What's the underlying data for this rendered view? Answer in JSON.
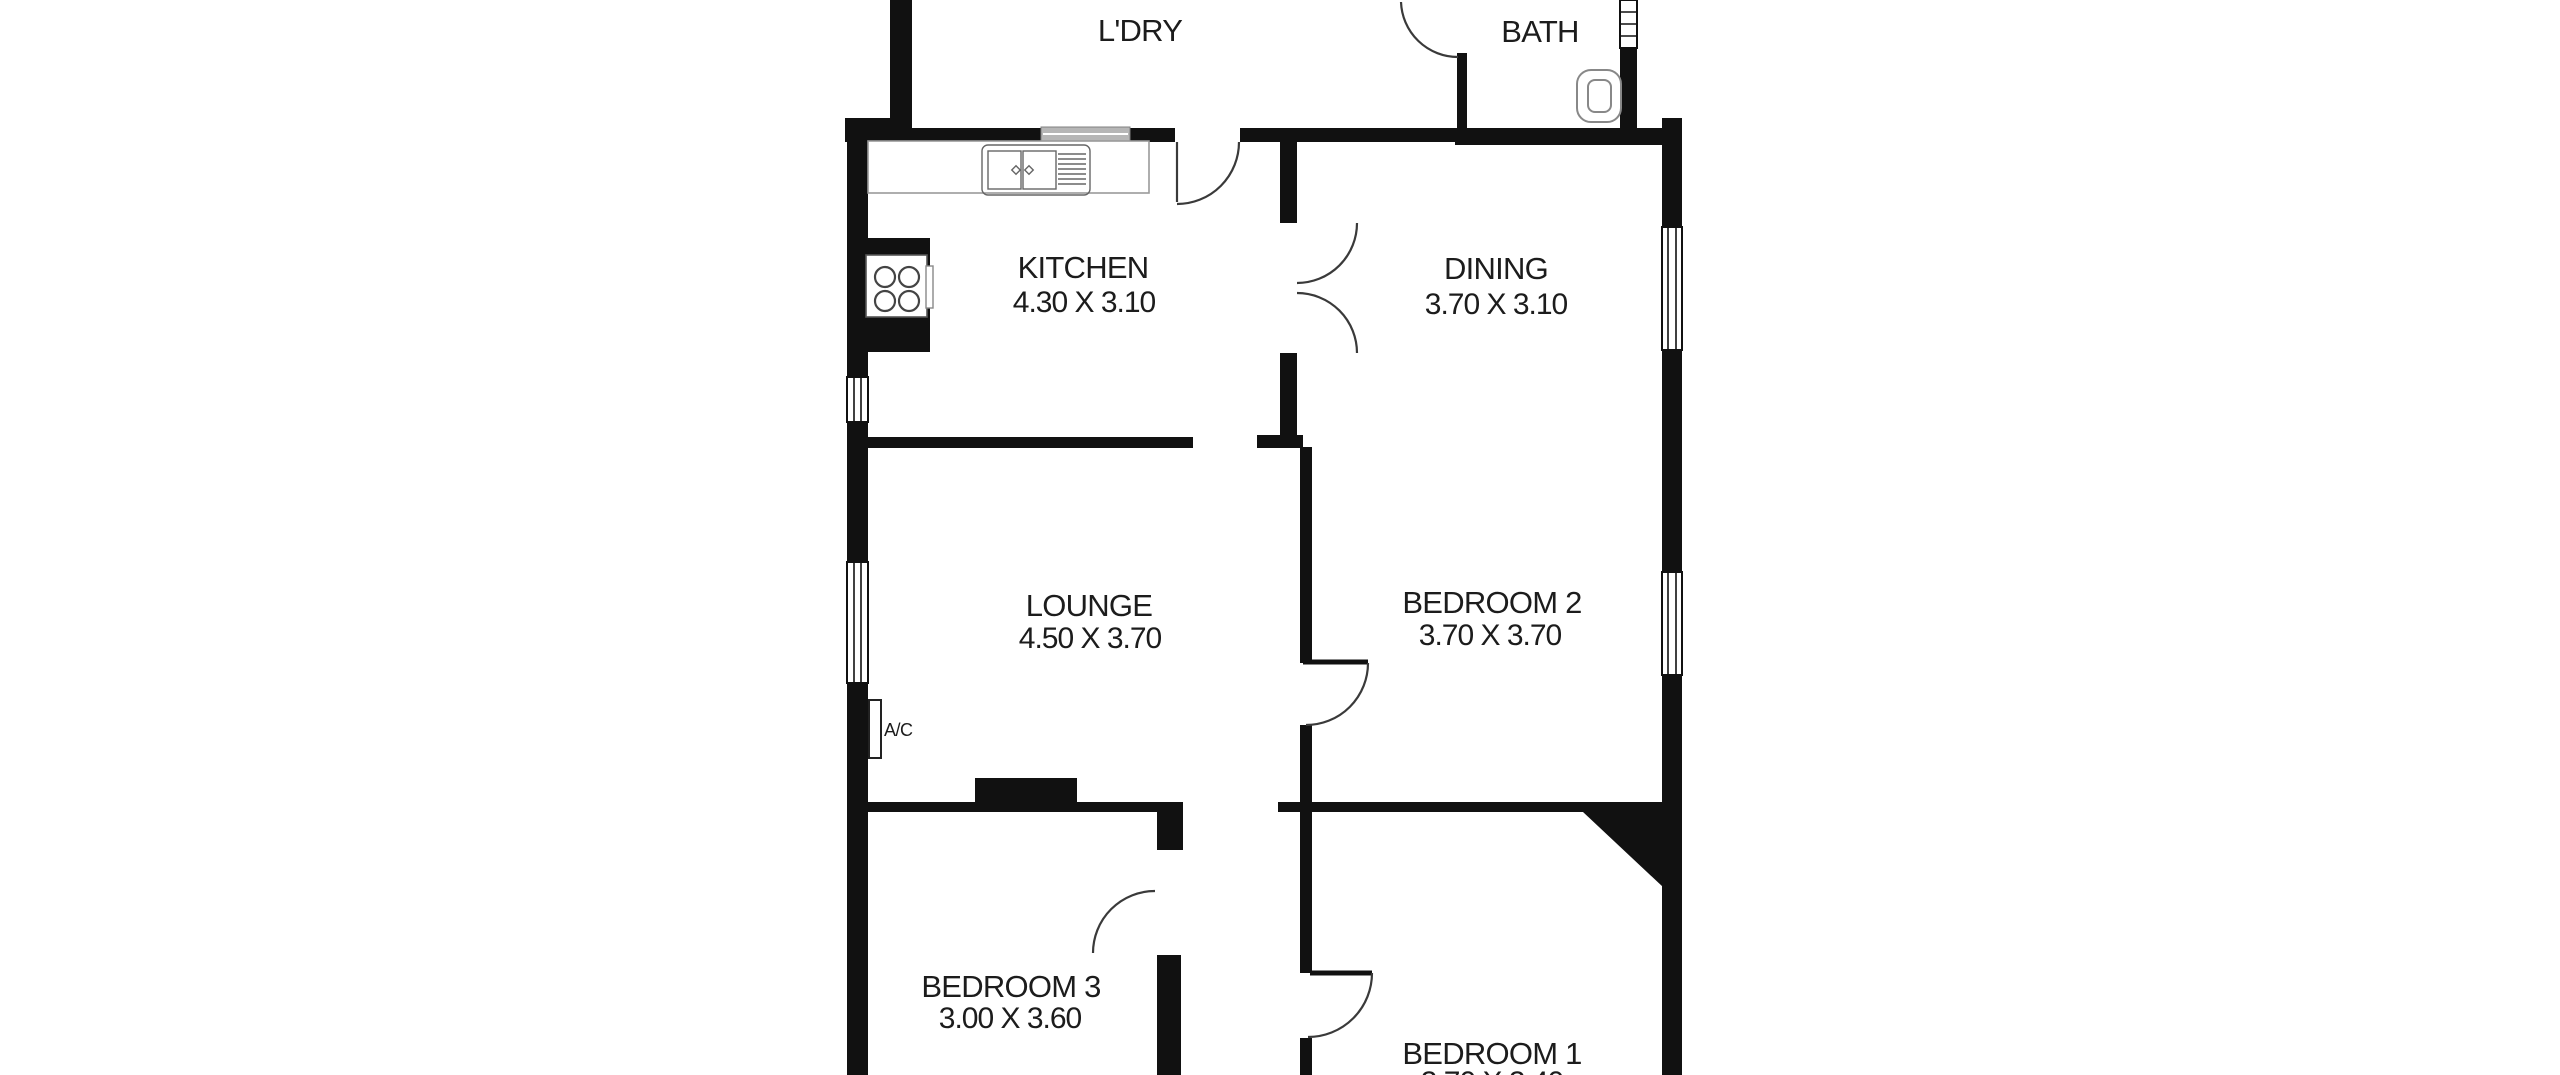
{
  "canvas": {
    "background": "#ffffff",
    "wall_color": "#111111",
    "text_color": "#1c1c1c"
  },
  "rooms": {
    "laundry": {
      "name": "L'DRY"
    },
    "bath": {
      "name": "BATH"
    },
    "kitchen": {
      "name": "KITCHEN",
      "dims": "4.30 X 3.10"
    },
    "dining": {
      "name": "DINING",
      "dims": "3.70 X 3.10"
    },
    "lounge": {
      "name": "LOUNGE",
      "dims": "4.50 X 3.70"
    },
    "bedroom2": {
      "name": "BEDROOM 2",
      "dims": "3.70 X 3.70"
    },
    "bedroom3": {
      "name": "BEDROOM 3",
      "dims": "3.00 X 3.60"
    },
    "bedroom1": {
      "name": "BEDROOM 1",
      "dims": "3.70 X 3.40"
    }
  },
  "fixtures": {
    "ac_label": "A/C"
  }
}
